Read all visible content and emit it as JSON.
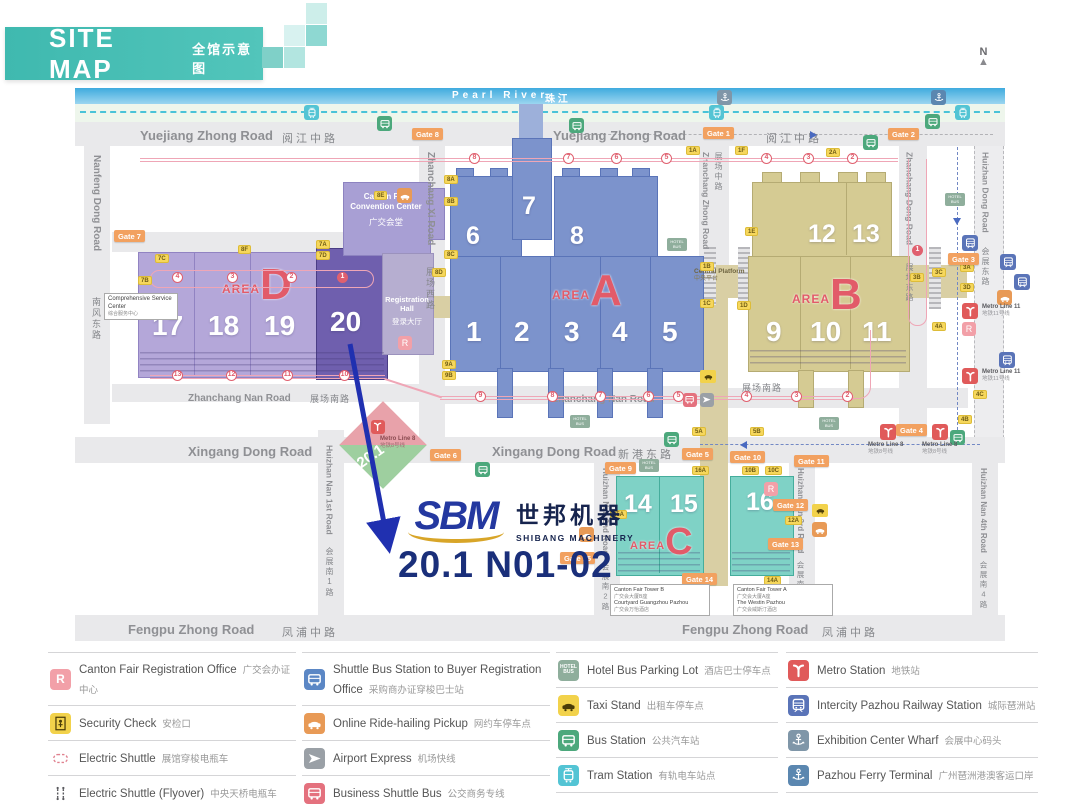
{
  "header": {
    "title_en": "SITE MAP",
    "title_cn": "全馆示意图"
  },
  "compass": {
    "label": "N"
  },
  "river": {
    "en": "Pearl River",
    "cn": "珠 江"
  },
  "roads": {
    "yuejiang": {
      "en": "Yuejiang Zhong Road",
      "cn": "阅江中路"
    },
    "nanfeng": {
      "en": "Nanfeng Dong Road",
      "cn": "南风东路"
    },
    "zhanchang_xi": {
      "en": "Zhanchang Xi Road",
      "cn": "展场西路"
    },
    "zhanchang_zhong": {
      "en": "Zhanchang Zhong Road",
      "cn": "展场中路"
    },
    "zhanchang_dong": {
      "en": "Zhanchang Dong Road",
      "cn": "展场东路"
    },
    "huizhan_dong": {
      "en": "Huizhan Dong Road",
      "cn": "会展东路"
    },
    "zhanchang_nan": {
      "en": "Zhanchang Nan Road",
      "cn": "展场南路"
    },
    "xingang": {
      "en": "Xingang Dong Road",
      "cn": "新港东路"
    },
    "fengpu": {
      "en": "Fengpu Zhong Road",
      "cn": "凤浦中路"
    },
    "hn1": {
      "en": "Huizhan Nan 1st Road",
      "cn": "会展南1路"
    },
    "hn2": {
      "en": "Huizhan Nan 2nd Road",
      "cn": "会展南2路"
    },
    "hn3": {
      "en": "Huizhan Nan 3rd Road",
      "cn": "会展南3路"
    },
    "hn4": {
      "en": "Huizhan Nan 4th Road",
      "cn": "会展南4路"
    }
  },
  "areas": {
    "d": {
      "prefix": "AREA",
      "letter": "D",
      "halls": [
        "17",
        "18",
        "19",
        "20"
      ]
    },
    "a": {
      "prefix": "AREA",
      "letter": "A",
      "halls_top": [
        "6",
        "7",
        "8"
      ],
      "halls": [
        "1",
        "2",
        "3",
        "4",
        "5"
      ]
    },
    "b": {
      "prefix": "AREA",
      "letter": "B",
      "halls_top": [
        "12",
        "13"
      ],
      "halls": [
        "9",
        "10",
        "11"
      ]
    },
    "c": {
      "prefix": "AREA",
      "letter": "C",
      "halls": [
        "14",
        "15",
        "16"
      ]
    }
  },
  "buildings": {
    "convention": {
      "en": "Canton Fair Convention Center",
      "cn": "广交会堂"
    },
    "registration": {
      "en": "Registration Hall",
      "cn": "登录大厅"
    },
    "service_center": {
      "en": "Comprehensive Service Center",
      "cn": "综合服务中心"
    },
    "central_platform": {
      "en": "Central Platform",
      "cn": "中央平台"
    },
    "pavilion": {
      "label": "20.1"
    },
    "tower_b": {
      "l1": "Canton Fair Tower B",
      "l2": "广交会大厦B座",
      "l3": "Courtyard Guangzhou Pazhou",
      "l4": "广交会万怡酒店"
    },
    "tower_a": {
      "l1": "Canton Fair Tower A",
      "l2": "广交会大厦A座",
      "l3": "The Westin Pazhou",
      "l4": "广交会威斯汀酒店"
    }
  },
  "metro": {
    "line8_en": "Metro Line 8",
    "line8_cn": "地铁8号线",
    "line11_en": "Metro Line 11",
    "line11_cn": "地铁11号线"
  },
  "booth": {
    "brand": "SBM",
    "brand_cn": "世邦机器",
    "brand_sub": "SHIBANG MACHINERY",
    "number": "20.1 N01-02"
  },
  "map_glyphs": {
    "r": "R",
    "hotel": "HOTEL BUS"
  },
  "gates": [
    "Gate 1",
    "Gate 2",
    "Gate 3",
    "Gate 4",
    "Gate 5",
    "Gate 6",
    "Gate 7",
    "Gate 8",
    "Gate 9",
    "Gate 10",
    "Gate 11",
    "Gate 12",
    "Gate 13",
    "Gate 14",
    "Gate 15"
  ],
  "door_tags": [
    "7B",
    "7C",
    "8F",
    "7A",
    "7D",
    "8E",
    "8D",
    "8A",
    "8B",
    "8C",
    "9A",
    "9B",
    "1A",
    "1F",
    "2A",
    "1B",
    "1C",
    "1D",
    "1E",
    "3B",
    "3C",
    "3A",
    "3D",
    "4A",
    "4C",
    "4B",
    "5A",
    "5B",
    "15A",
    "16A",
    "10B",
    "10C",
    "12A",
    "14A"
  ],
  "shuttle_stops": {
    "north": [
      "8",
      "7",
      "6",
      "5",
      "4",
      "3",
      "2"
    ],
    "east": [
      "1"
    ],
    "d_row": [
      "4",
      "3",
      "2",
      "1"
    ],
    "d_south": [
      "13",
      "12",
      "11",
      "10"
    ],
    "a_south": [
      "9",
      "8",
      "7",
      "6",
      "5"
    ],
    "b_south": [
      "4",
      "3",
      "2"
    ]
  },
  "legend": {
    "columns": [
      [
        {
          "glyph": "R",
          "en": "Canton Fair Registration Office",
          "cn": "广交会办证中心",
          "icon": "registration-icon"
        },
        {
          "en": "Security Check",
          "cn": "安检口",
          "icon": "security-check-icon"
        },
        {
          "en": "Electric Shuttle",
          "cn": "展馆穿梭电瓶车",
          "icon": "electric-shuttle-icon"
        },
        {
          "en": "Electric Shuttle (Flyover)",
          "cn": "中央天桥电瓶车",
          "icon": "electric-shuttle-flyover-icon"
        }
      ],
      [
        {
          "en": "Shuttle Bus Station to Buyer Registration Office",
          "cn": "采购商办证穿梭巴士站",
          "icon": "shuttle-bus-icon"
        },
        {
          "en": "Online Ride-hailing Pickup",
          "cn": "网约车停车点",
          "icon": "ride-hailing-icon"
        },
        {
          "en": "Airport Express",
          "cn": "机场快线",
          "icon": "airport-express-icon"
        },
        {
          "en": "Business Shuttle Bus",
          "cn": "公交商务专线",
          "icon": "business-shuttle-icon"
        }
      ],
      [
        {
          "glyph": "HOTEL BUS",
          "en": "Hotel Bus Parking Lot",
          "cn": "酒店巴士停车点",
          "icon": "hotel-bus-icon"
        },
        {
          "en": "Taxi Stand",
          "cn": "出租车停车点",
          "icon": "taxi-icon"
        },
        {
          "en": "Bus Station",
          "cn": "公共汽车站",
          "icon": "bus-station-icon"
        },
        {
          "en": "Tram Station",
          "cn": "有轨电车站点",
          "icon": "tram-station-icon"
        }
      ],
      [
        {
          "en": "Metro Station",
          "cn": "地铁站",
          "icon": "metro-icon"
        },
        {
          "en": "Intercity Pazhou Railway Station",
          "cn": "城际琶洲站",
          "icon": "intercity-rail-icon"
        },
        {
          "en": "Exhibition Center Wharf",
          "cn": "会展中心码头",
          "icon": "wharf-icon"
        },
        {
          "en": "Pazhou Ferry Terminal",
          "cn": "广州琶洲港澳客运口岸",
          "icon": "ferry-icon"
        }
      ]
    ]
  },
  "colors": {
    "accent_teal": "#4fc2b8",
    "area_d": "#b4a7d9",
    "hall20": "#6f5fae",
    "area_a": "#7c93cc",
    "area_b": "#d5cb93",
    "area_c": "#7fd2c6",
    "route_pink": "#efa6b6",
    "gate_orange": "#f2a160",
    "metro_red": "#e05a5a",
    "brand_blue": "#2438a0",
    "gold": "#d8a528"
  }
}
